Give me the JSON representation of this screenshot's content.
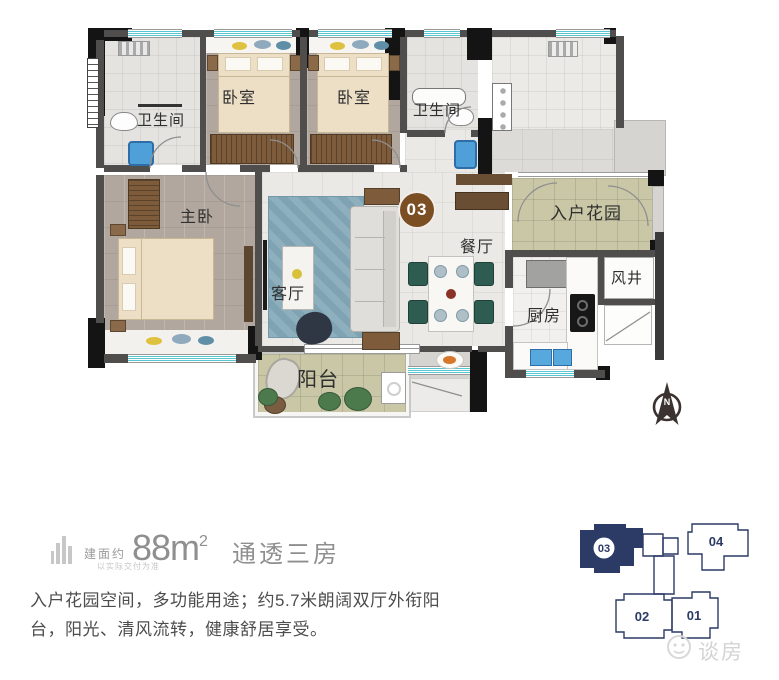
{
  "plan": {
    "unit_badge": "03",
    "compass_label": "N",
    "rooms": [
      {
        "id": "bathroom-1",
        "label": "卫生间"
      },
      {
        "id": "bedroom-1",
        "label": "卧室"
      },
      {
        "id": "bedroom-2",
        "label": "卧室"
      },
      {
        "id": "bathroom-2",
        "label": "卫生间"
      },
      {
        "id": "entry-garden",
        "label": "入户花园"
      },
      {
        "id": "master-bedroom",
        "label": "主卧"
      },
      {
        "id": "living-room",
        "label": "客厅"
      },
      {
        "id": "dining-room",
        "label": "餐厅"
      },
      {
        "id": "kitchen",
        "label": "厨房"
      },
      {
        "id": "air-shaft",
        "label": "风井"
      },
      {
        "id": "balcony",
        "label": "阳台"
      }
    ],
    "badge_color": "#7b4e24"
  },
  "info": {
    "area_prefix": "建面约",
    "area_value": "88m",
    "area_sup": "2",
    "area_title": "通透三房",
    "disclaimer": "以实际交付为准",
    "description_line1": "入户花园空间，多功能用途；约5.7米朗阔双厅外衔阳",
    "description_line2": "台，阳光、清风流转，健康舒居享受。"
  },
  "keyplan": {
    "highlight_color": "#2c3a66",
    "units": [
      {
        "label": "03",
        "highlighted": true
      },
      {
        "label": "04",
        "highlighted": false
      },
      {
        "label": "02",
        "highlighted": false
      },
      {
        "label": "01",
        "highlighted": false
      }
    ]
  },
  "watermark": {
    "text": "谈房"
  }
}
